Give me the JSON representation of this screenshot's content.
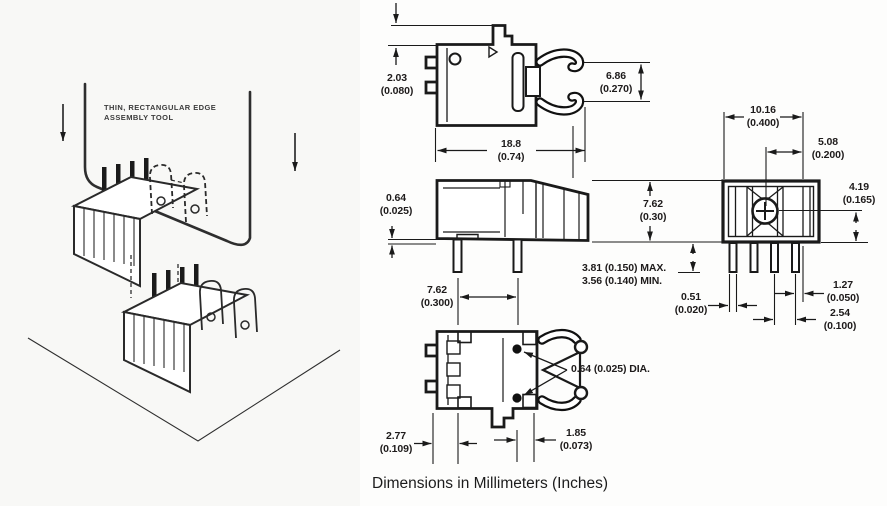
{
  "illustration": {
    "tool_label_line1": "THIN, RECTANGULAR EDGE",
    "tool_label_line2": "ASSEMBLY TOOL"
  },
  "caption": "Dimensions in Millimeters (Inches)",
  "dims": {
    "top_offset": {
      "line1": "2.03",
      "line2": "(0.080)"
    },
    "clip_gap": {
      "line1": "6.86",
      "line2": "(0.270)"
    },
    "body_width": {
      "line1": "18.8",
      "line2": "(0.74)"
    },
    "standoff": {
      "line1": "0.64",
      "line2": "(0.025)"
    },
    "body_height": {
      "line1": "7.62",
      "line2": "(0.30)"
    },
    "pin_length": {
      "line1": "3.81 (0.150) MAX.",
      "line2": "3.56 (0.140) MIN."
    },
    "pin_span": {
      "line1": "7.62",
      "line2": "(0.300)"
    },
    "pin_dia": {
      "line1": "0.64 (0.025) DIA."
    },
    "left_edge": {
      "line1": "2.77",
      "line2": "(0.109)"
    },
    "tab_offset": {
      "line1": "1.85",
      "line2": "(0.073)"
    },
    "end_width": {
      "line1": "10.16",
      "line2": "(0.400)"
    },
    "end_half_width": {
      "line1": "5.08",
      "line2": "(0.200)"
    },
    "end_height": {
      "line1": "4.19",
      "line2": "(0.165)"
    },
    "pin_width": {
      "line1": "0.51",
      "line2": "(0.020)"
    },
    "pin_edge_offset": {
      "line1": "1.27",
      "line2": "(0.050)"
    },
    "pin_pitch": {
      "line1": "2.54",
      "line2": "(0.100)"
    }
  },
  "colors": {
    "line": "#1a1a1a",
    "text": "#1e1b1b",
    "background": "#fdfdfc"
  }
}
